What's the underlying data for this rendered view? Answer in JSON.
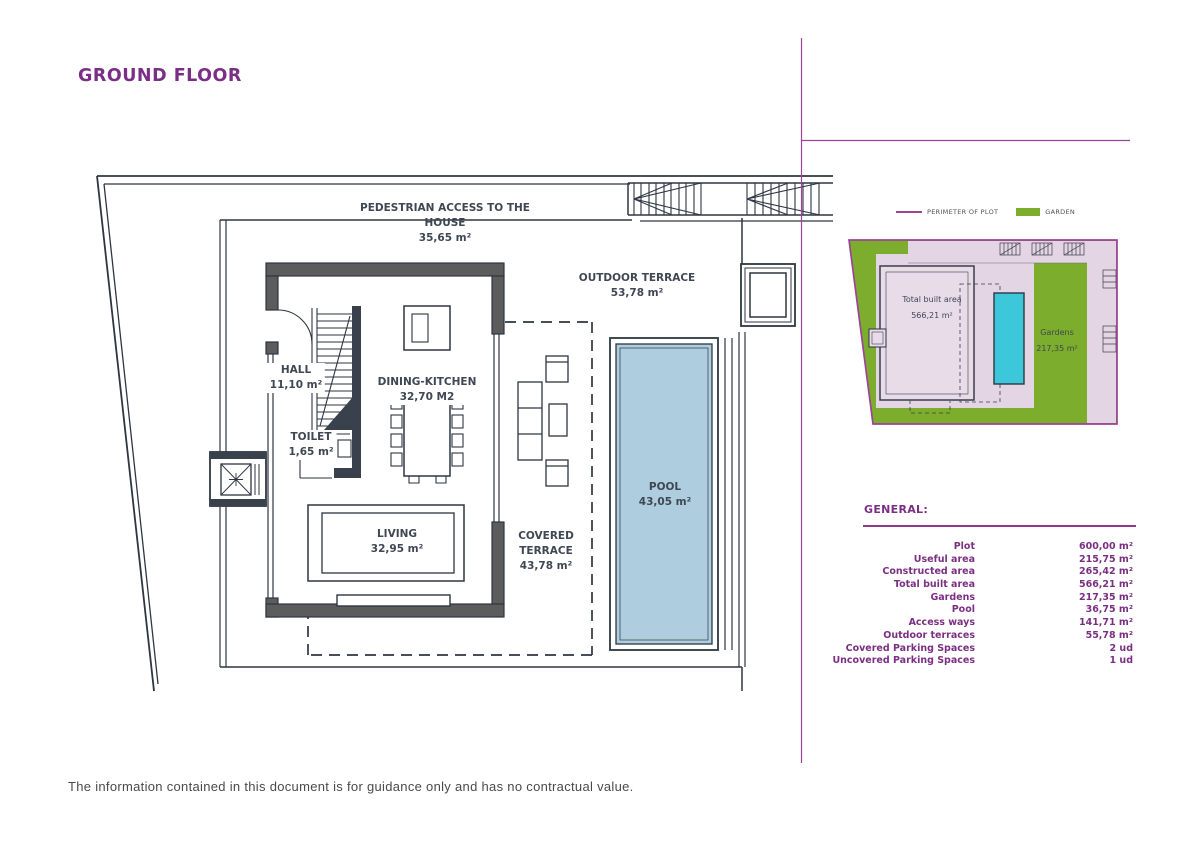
{
  "page": {
    "title": "GROUND FLOOR",
    "footer": "The information contained in this document is for guidance only and has no contractual value."
  },
  "colors": {
    "accent_purple": "#7b2f83",
    "perimeter_purple": "#9c4398",
    "plan_line": "#2e3642",
    "wall_gray": "#5c5c5c",
    "pool_fill": "#aecdde",
    "garden_green": "#7cad2c",
    "site_built_fill": "#e4d5e4",
    "site_pool_cyan": "#3cc7da"
  },
  "floor_plan": {
    "rooms": [
      {
        "name": "pedestrian-access",
        "line1": "PEDESTRIAN ACCESS TO THE",
        "line2": "HOUSE",
        "area": "35,65 m²"
      },
      {
        "name": "outdoor-terrace",
        "line1": "OUTDOOR TERRACE",
        "area": "53,78 m²"
      },
      {
        "name": "hall",
        "line1": "HALL",
        "area": "11,10 m²"
      },
      {
        "name": "dining-kitchen",
        "line1": "DINING-KITCHEN",
        "area": "32,70 M2"
      },
      {
        "name": "toilet",
        "line1": "TOILET",
        "area": "1,65 m²"
      },
      {
        "name": "living",
        "line1": "LIVING",
        "area": "32,95 m²"
      },
      {
        "name": "covered-terrace",
        "line1": "COVERED",
        "line2": "TERRACE",
        "area": "43,78 m²"
      },
      {
        "name": "pool",
        "line1": "POOL",
        "area": "43,05 m²"
      }
    ]
  },
  "site_plan": {
    "legend": [
      {
        "label": "PERIMETER OF PLOT"
      },
      {
        "label": "GARDEN"
      }
    ],
    "labels": [
      {
        "name": "total-built-area",
        "line1": "Total built area",
        "line2": "566,21 m²"
      },
      {
        "name": "gardens",
        "line1": "Gardens",
        "line2": "217,35 m²"
      }
    ]
  },
  "general": {
    "heading": "GENERAL:",
    "rows": [
      {
        "label": "Plot",
        "value": "600,00 m²"
      },
      {
        "label": "Useful area",
        "value": "215,75 m²"
      },
      {
        "label": "Constructed area",
        "value": "265,42 m²"
      },
      {
        "label": "Total built area",
        "value": "566,21 m²"
      },
      {
        "label": "Gardens",
        "value": "217,35 m²"
      },
      {
        "label": "Pool",
        "value": "36,75 m²"
      },
      {
        "label": "Access ways",
        "value": "141,71 m²"
      },
      {
        "label": "Outdoor terraces",
        "value": "55,78 m²"
      },
      {
        "label": "Covered Parking Spaces",
        "value": "2 ud"
      },
      {
        "label": "Uncovered Parking Spaces",
        "value": "1 ud"
      }
    ]
  }
}
